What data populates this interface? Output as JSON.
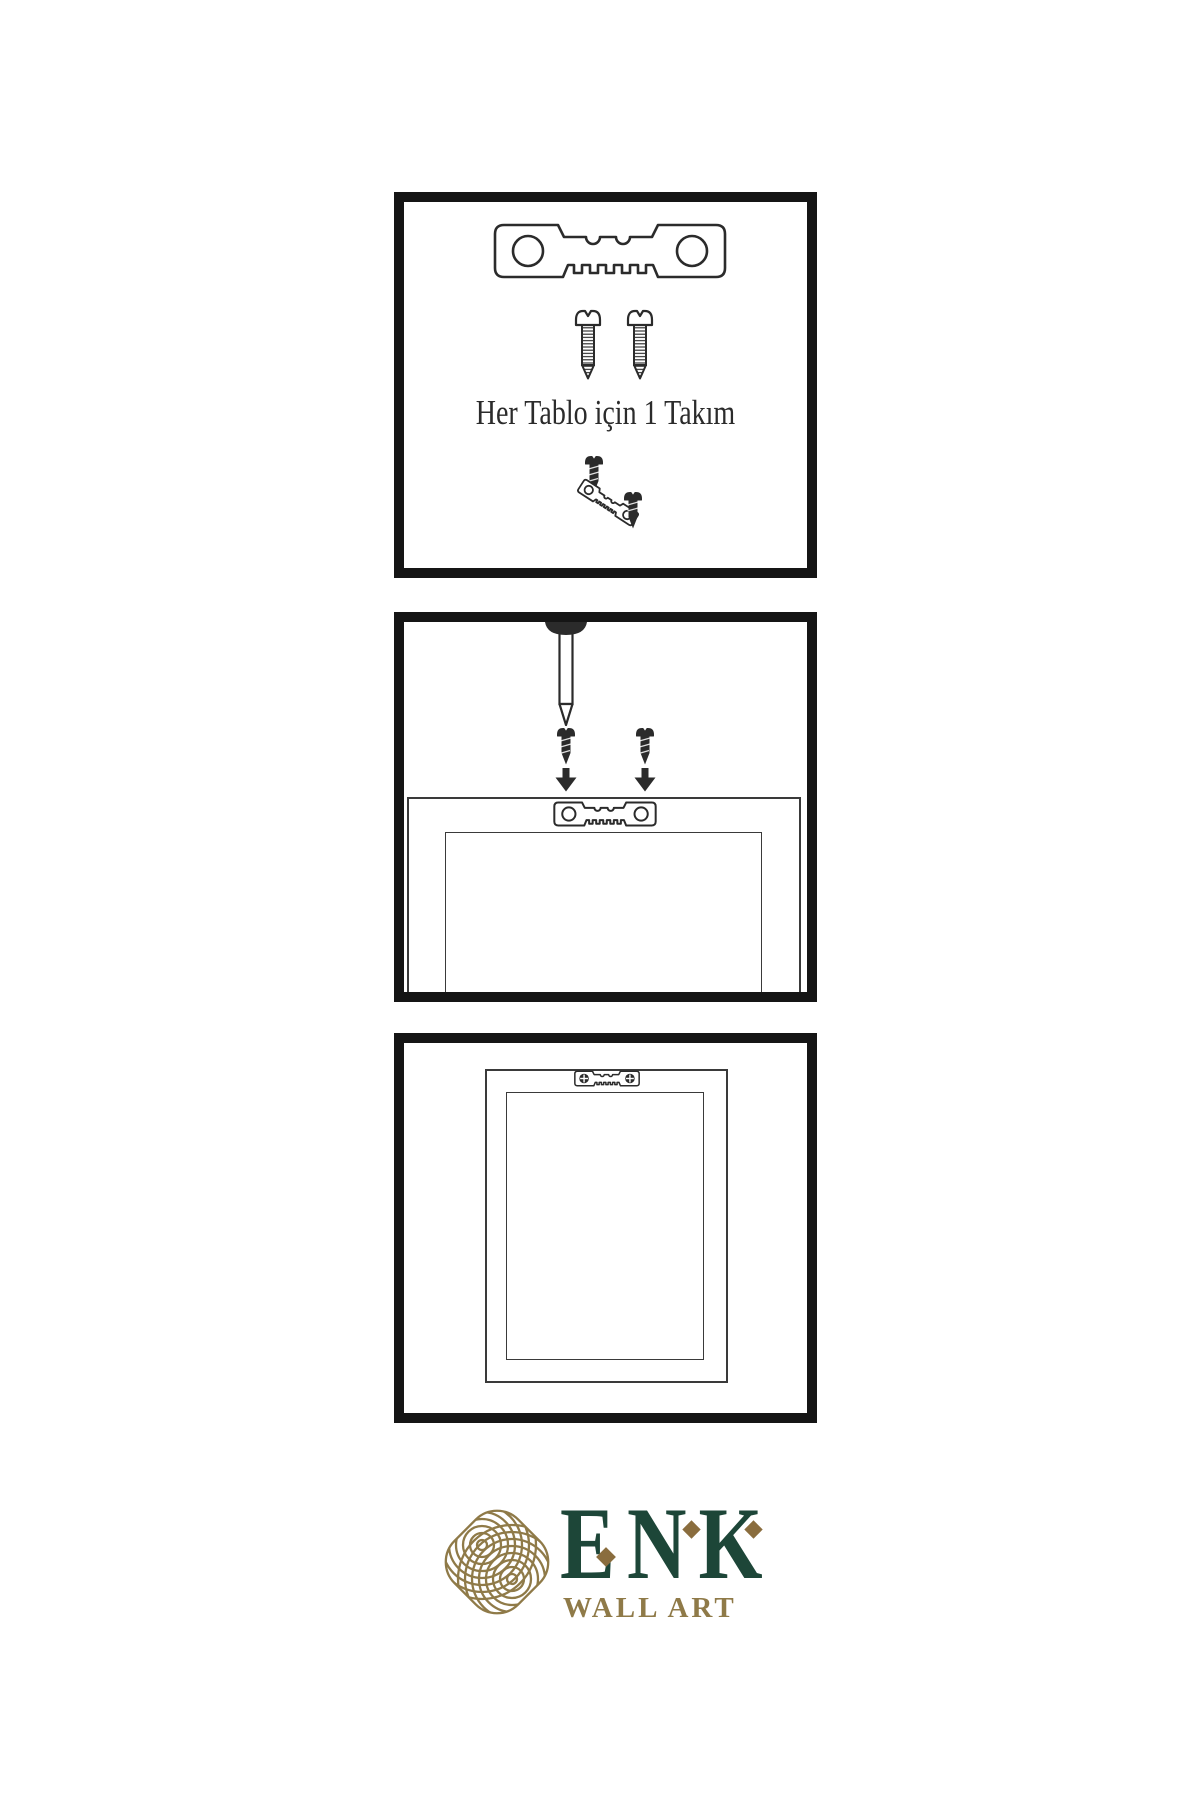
{
  "colors": {
    "background": "#ffffff",
    "ink": "#2b2b2b",
    "panel_border": "#151515",
    "line": "#3a3a3a",
    "brand_green": "#1d4638",
    "brand_gold": "#8f7a48",
    "brand_gold_dark": "#8a6d3e"
  },
  "steps": [
    {
      "name": "hardware-kit",
      "caption": "Her Tablo için 1 Takım",
      "icons": [
        "sawtooth-hanger-icon",
        "screw-icon",
        "screw-icon",
        "screws-into-hanger-icon"
      ]
    },
    {
      "name": "wall-nail-and-screws",
      "icons": [
        "nail-in-wall-icon",
        "dark-screw-icon",
        "dark-screw-icon",
        "down-arrow-icon",
        "down-arrow-icon",
        "sawtooth-hanger-on-frame-icon",
        "frame-back-icon"
      ]
    },
    {
      "name": "framed-art-hung",
      "icons": [
        "frame-front-icon",
        "mounted-sawtooth-hanger-icon"
      ]
    }
  ],
  "logo": {
    "icon": "infinity-knot-icon",
    "letters": [
      "E",
      "N",
      "K"
    ],
    "subtitle": "WALL ART"
  }
}
